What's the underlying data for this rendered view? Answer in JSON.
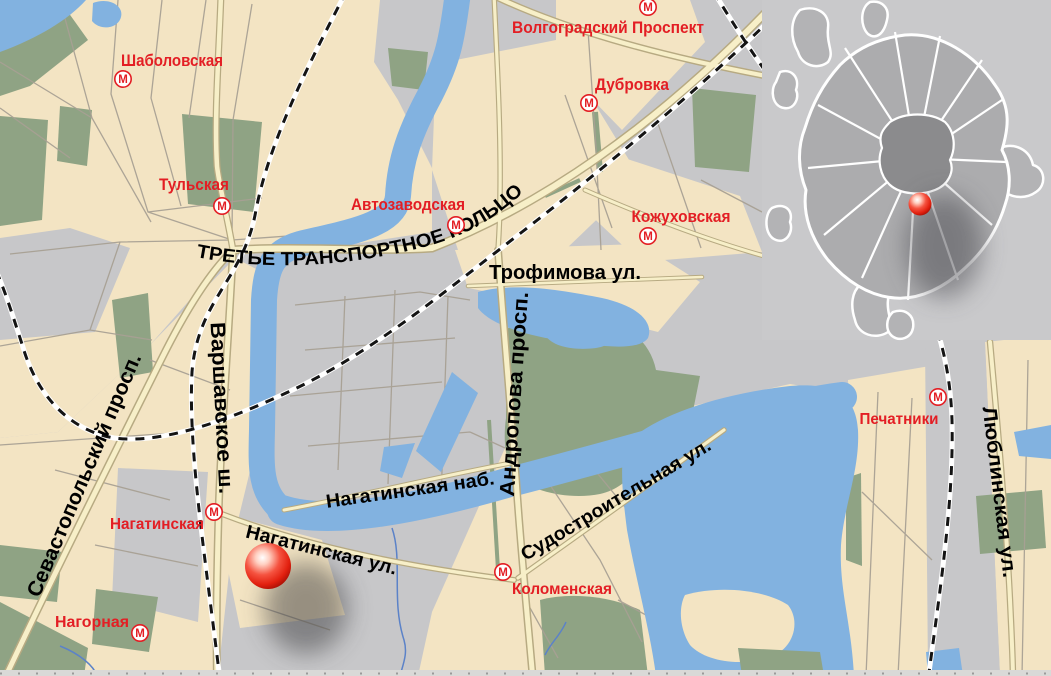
{
  "metro": {
    "icon_letter": "М"
  },
  "stations": [
    {
      "id": "shabolovskaya",
      "name": "Шаболовская"
    },
    {
      "id": "tulskaya",
      "name": "Тульская"
    },
    {
      "id": "avtozavodskaya",
      "name": "Автозаводская"
    },
    {
      "id": "volgogradsky-prospekt",
      "name": "Волгоградский Проспект"
    },
    {
      "id": "dubrovka",
      "name": "Дубровка"
    },
    {
      "id": "kozhukhovskaya",
      "name": "Кожуховская"
    },
    {
      "id": "nagatinskaya",
      "name": "Нагатинская"
    },
    {
      "id": "nagornaya",
      "name": "Нагорная"
    },
    {
      "id": "kolomenskaya",
      "name": "Коломенская"
    },
    {
      "id": "pechatniki",
      "name": "Печатники"
    }
  ],
  "streets": [
    {
      "id": "ttk",
      "name": "ТРЕТЬЕ ТРАНСПОРТНОЕ КОЛЬЦО"
    },
    {
      "id": "trofimova",
      "name": "Трофимова ул."
    },
    {
      "id": "varshavskoe",
      "name": "Варшавское ш."
    },
    {
      "id": "sevastopolsky",
      "name": "Севастопольский просп."
    },
    {
      "id": "nagatinskaya-nab",
      "name": "Нагатинская наб."
    },
    {
      "id": "nagatinskaya-ul",
      "name": "Нагатинская ул."
    },
    {
      "id": "andropova",
      "name": "Андропова просп."
    },
    {
      "id": "sudostroitelnaya",
      "name": "Судостроительная ул."
    },
    {
      "id": "lyublinskaya",
      "name": "Люблинская ул."
    }
  ],
  "colors": {
    "land_beige": "#f3e4c3",
    "urban_gray": "#c7c7c9",
    "park_green": "#8fa384",
    "water_blue": "#82b2e0",
    "road_fill": "#f7efc8",
    "road_casing": "#b7aa82",
    "railway_black": "#141414",
    "metro_red": "#e31e24",
    "marker_red": "#e8311f",
    "inset_city_gray": "#acacae",
    "inset_center_gray": "#8b8b8d"
  }
}
